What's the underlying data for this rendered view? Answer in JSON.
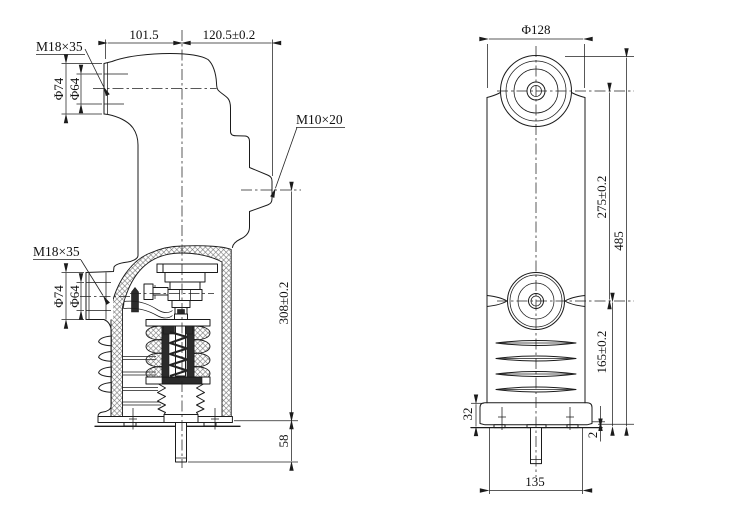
{
  "meta": {
    "bg": "#ffffff",
    "ink": "#1b1b1b"
  },
  "left_view": {
    "label_thread_upper": "M18×35",
    "dim_arm_length": "101.5",
    "dim_arm_to_tip": "120.5±0.2",
    "dim_upper_od": "Φ74",
    "dim_upper_id": "Φ64",
    "label_thread_side": "M10×20",
    "label_thread_lower": "M18×35",
    "dim_lower_od": "Φ74",
    "dim_lower_id": "Φ64",
    "dim_height": "308±0.2",
    "dim_rod": "58"
  },
  "right_view": {
    "dim_diameter": "Φ128",
    "dim_centers": "275±0.2",
    "dim_total_height": "485",
    "dim_lower_section": "165±0.2",
    "dim_flange": "32",
    "dim_pad": "2",
    "dim_base_width": "135"
  }
}
